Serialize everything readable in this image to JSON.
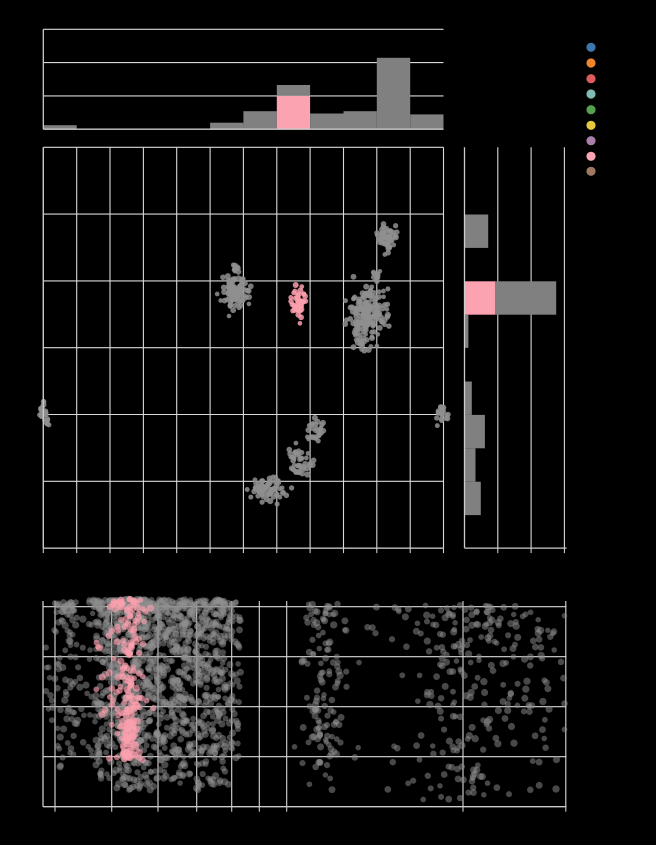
{
  "figure": {
    "width": 656,
    "height": 845,
    "background": "#000000",
    "units": "px"
  },
  "palette": {
    "grid": "#D9D9D9",
    "spine": "#CCCCCC",
    "tick": "#CCCCCC",
    "bar_gray": "#808080",
    "highlight_pink": "#FBA3B1",
    "point_gray": "#8F8F8F",
    "point_pink": "#FB9FAD"
  },
  "legend": {
    "dot_cx": 591,
    "dot_radius": 4.6,
    "items": [
      {
        "name": "series-blue",
        "color": "#3E76AF",
        "cy": 47.3
      },
      {
        "name": "series-orange",
        "color": "#F0862B",
        "cy": 63.0
      },
      {
        "name": "series-red",
        "color": "#DC5C5C",
        "cy": 78.7
      },
      {
        "name": "series-teal",
        "color": "#7FBCB4",
        "cy": 94.0
      },
      {
        "name": "series-green",
        "color": "#55A14B",
        "cy": 109.7
      },
      {
        "name": "series-yellow",
        "color": "#E6C83F",
        "cy": 125.3
      },
      {
        "name": "series-purple",
        "color": "#A87FA8",
        "cy": 140.7
      },
      {
        "name": "series-pink",
        "color": "#FBA5B2",
        "cy": 156.3
      },
      {
        "name": "series-brown",
        "color": "#9F7862",
        "cy": 171.3
      }
    ]
  },
  "chart_data": [
    {
      "id": "top_histogram",
      "type": "bar",
      "orientation": "vertical",
      "stacked": true,
      "plot": {
        "x0": 43.3,
        "x1": 443.5,
        "y_top": 29.3,
        "y_axis": 129.2
      },
      "gridlines_y": [
        29.3,
        62.6,
        95.9
      ],
      "spine_x": 43.3,
      "bars": [
        {
          "x0": 43.3,
          "x1": 76.7,
          "segs": [
            {
              "c": "gray",
              "h": 4.0
            }
          ]
        },
        {
          "x0": 210.1,
          "x1": 243.4,
          "segs": [
            {
              "c": "gray",
              "h": 6.5
            }
          ]
        },
        {
          "x0": 243.4,
          "x1": 276.8,
          "segs": [
            {
              "c": "gray",
              "h": 18.0
            }
          ]
        },
        {
          "x0": 276.8,
          "x1": 310.1,
          "segs": [
            {
              "c": "pink",
              "h": 33.4
            },
            {
              "c": "gray",
              "h": 10.8
            }
          ]
        },
        {
          "x0": 310.1,
          "x1": 343.5,
          "segs": [
            {
              "c": "gray",
              "h": 15.7
            }
          ]
        },
        {
          "x0": 343.5,
          "x1": 376.8,
          "segs": [
            {
              "c": "gray",
              "h": 18.0
            }
          ]
        },
        {
          "x0": 376.8,
          "x1": 410.2,
          "segs": [
            {
              "c": "gray",
              "h": 71.4
            }
          ]
        },
        {
          "x0": 410.2,
          "x1": 443.5,
          "segs": [
            {
              "c": "gray",
              "h": 14.8
            }
          ]
        }
      ]
    },
    {
      "id": "main_scatter",
      "type": "scatter",
      "plot": {
        "x0": 43.3,
        "x1": 443.5,
        "y0": 147.3,
        "y1": 548.1
      },
      "grid_x": [
        43.3,
        76.7,
        110.0,
        143.4,
        176.7,
        210.1,
        243.4,
        276.8,
        310.1,
        343.5,
        376.8,
        410.2,
        443.5
      ],
      "grid_y": [
        147.3,
        214.1,
        280.9,
        347.7,
        414.5,
        481.3,
        548.1
      ],
      "tick_len": 5,
      "point_r": 2.7,
      "point_opacity": 0.85,
      "clusters": [
        {
          "cx": 44,
          "cy": 412,
          "sx": 2.6,
          "sy": 5.5,
          "n": 25,
          "c": "gray"
        },
        {
          "cx": 237,
          "cy": 291,
          "sx": 7.0,
          "sy": 9.5,
          "n": 100,
          "c": "gray"
        },
        {
          "cx": 236,
          "cy": 267,
          "sx": 2.2,
          "sy": 2.2,
          "n": 7,
          "c": "gray"
        },
        {
          "cx": 299,
          "cy": 304,
          "sx": 3.6,
          "sy": 7.0,
          "n": 50,
          "c": "pink"
        },
        {
          "cx": 367,
          "cy": 312,
          "sx": 9.0,
          "sy": 14.0,
          "n": 170,
          "c": "gray"
        },
        {
          "cx": 386,
          "cy": 238,
          "sx": 5.5,
          "sy": 6.5,
          "n": 55,
          "c": "gray"
        },
        {
          "cx": 377,
          "cy": 275,
          "sx": 2.6,
          "sy": 3.0,
          "n": 9,
          "c": "gray"
        },
        {
          "cx": 362,
          "cy": 345,
          "sx": 4.0,
          "sy": 3.0,
          "n": 10,
          "c": "gray"
        },
        {
          "cx": 442,
          "cy": 413,
          "sx": 2.6,
          "sy": 4.6,
          "n": 18,
          "c": "gray"
        },
        {
          "cx": 315,
          "cy": 430,
          "sx": 4.0,
          "sy": 6.2,
          "n": 28,
          "c": "gray"
        },
        {
          "cx": 299,
          "cy": 464,
          "sx": 5.6,
          "sy": 7.0,
          "n": 45,
          "c": "gray"
        },
        {
          "cx": 266,
          "cy": 490,
          "sx": 8.6,
          "sy": 6.0,
          "n": 70,
          "c": "gray"
        }
      ]
    },
    {
      "id": "right_histogram",
      "type": "bar",
      "orientation": "horizontal",
      "stacked": true,
      "plot": {
        "y0": 147.3,
        "y1": 548.1,
        "x_spine": 464.5,
        "x_end": 566.5
      },
      "gridlines_x": [
        497.8,
        531.1,
        564.4
      ],
      "axis_y": 548.1,
      "tick_len": 5,
      "bars": [
        {
          "y0": 214.5,
          "y1": 247.9,
          "segs": [
            {
              "c": "gray",
              "w": 23.7
            }
          ]
        },
        {
          "y0": 281.3,
          "y1": 314.7,
          "segs": [
            {
              "c": "pink",
              "w": 30.5
            },
            {
              "c": "gray",
              "w": 61.2
            }
          ]
        },
        {
          "y0": 314.7,
          "y1": 347.9,
          "segs": [
            {
              "c": "gray",
              "w": 3.9
            }
          ]
        },
        {
          "y0": 381.5,
          "y1": 414.9,
          "segs": [
            {
              "c": "gray",
              "w": 7.3
            }
          ]
        },
        {
          "y0": 414.9,
          "y1": 448.3,
          "segs": [
            {
              "c": "gray",
              "w": 20.4
            }
          ]
        },
        {
          "y0": 448.3,
          "y1": 481.7,
          "segs": [
            {
              "c": "gray",
              "w": 11.0
            }
          ]
        },
        {
          "y0": 481.7,
          "y1": 515.1,
          "segs": [
            {
              "c": "gray",
              "w": 16.3
            }
          ]
        }
      ]
    },
    {
      "id": "bottom_strip",
      "type": "scatter",
      "x_scale": "log",
      "plot": {
        "x0": 43.0,
        "x1": 566.5,
        "y0": 601.0,
        "y1": 806.7
      },
      "grid_x": [
        55.0,
        111.7,
        158.0,
        196.7,
        231.7,
        259.3,
        286.7,
        463.0,
        565.8
      ],
      "grid_y": [
        606.7,
        656.7,
        706.7,
        756.7
      ],
      "axis_y": 806.7,
      "spine_x": 43.0,
      "tick_len": 5,
      "point_r": 3.2,
      "gray_opacity": 0.5,
      "pink_opacity": 0.65,
      "strips": [
        {
          "cx": 50,
          "sx": 3,
          "n": 12,
          "y0": 640,
          "y1": 735,
          "bias": 1.0,
          "c": "gray"
        },
        {
          "cx": 68,
          "sx": 6,
          "n": 90,
          "y0": 602,
          "y1": 768,
          "bias": 1.6,
          "c": "gray"
        },
        {
          "cx": 103,
          "sx": 7,
          "n": 160,
          "y0": 600,
          "y1": 782,
          "bias": 1.5,
          "c": "gray"
        },
        {
          "cx": 122,
          "sx": 7,
          "n": 200,
          "y0": 599,
          "y1": 788,
          "bias": 1.4,
          "c": "gray"
        },
        {
          "cx": 141,
          "sx": 7,
          "n": 200,
          "y0": 599,
          "y1": 790,
          "bias": 1.4,
          "c": "gray"
        },
        {
          "cx": 160,
          "sx": 7,
          "n": 180,
          "y0": 600,
          "y1": 780,
          "bias": 1.4,
          "c": "gray"
        },
        {
          "cx": 180,
          "sx": 7,
          "n": 180,
          "y0": 600,
          "y1": 785,
          "bias": 1.4,
          "c": "gray"
        },
        {
          "cx": 200,
          "sx": 7,
          "n": 180,
          "y0": 600,
          "y1": 792,
          "bias": 1.4,
          "c": "gray"
        },
        {
          "cx": 218,
          "sx": 7,
          "n": 150,
          "y0": 600,
          "y1": 790,
          "bias": 1.4,
          "c": "gray"
        },
        {
          "cx": 232,
          "sx": 5,
          "n": 60,
          "y0": 602,
          "y1": 760,
          "bias": 1.5,
          "c": "gray"
        },
        {
          "cx": 322,
          "sx": 11,
          "n": 130,
          "y0": 604,
          "y1": 792,
          "bias": 1.2,
          "c": "gray"
        },
        {
          "cx": 468,
          "sx": 38,
          "n": 240,
          "y0": 605,
          "y1": 800,
          "bias": 1.3,
          "c": "gray"
        },
        {
          "cx": 545,
          "sx": 14,
          "n": 25,
          "y0": 610,
          "y1": 740,
          "bias": 1.1,
          "c": "gray"
        },
        {
          "cx": 128,
          "sx": 8,
          "n": 170,
          "y0": 599,
          "y1": 762,
          "bias": 1.35,
          "c": "pink"
        },
        {
          "cx": 131,
          "sx": 4,
          "n": 25,
          "y0": 700,
          "y1": 762,
          "bias": 1.0,
          "c": "pink",
          "r": 4.2
        },
        {
          "cx": 103,
          "sx": 8,
          "n": 8,
          "y0": 640,
          "y1": 720,
          "bias": 1.0,
          "c": "pink"
        }
      ]
    }
  ]
}
